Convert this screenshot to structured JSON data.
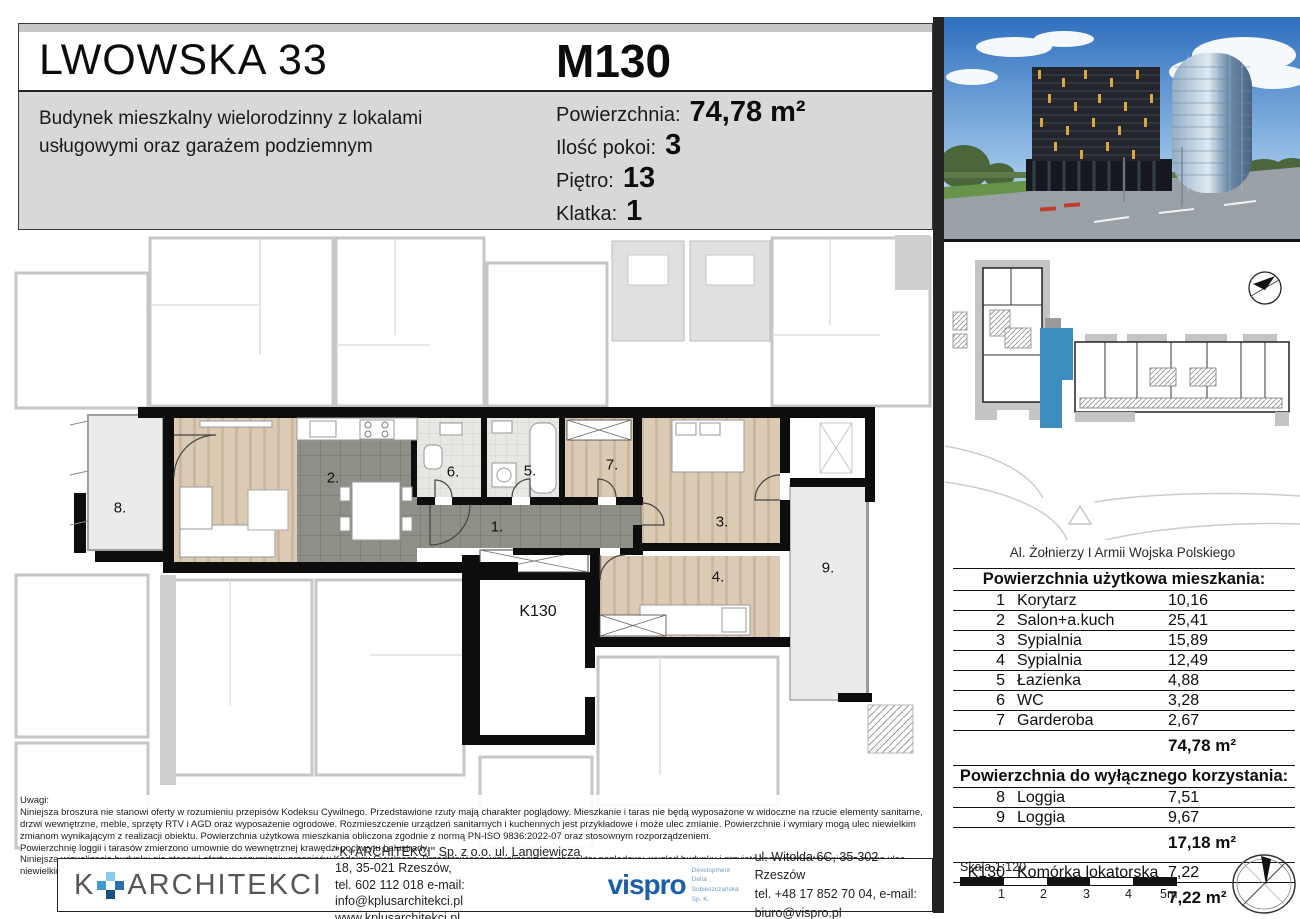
{
  "header": {
    "project_title": "LWOWSKA 33",
    "project_subtitle": "Budynek mieszkalny wielorodzinny z lokalami usługowymi oraz garażem podziemnym",
    "unit_id": "M130",
    "details": [
      {
        "label": "Powierzchnia:",
        "value": "74,78 m²"
      },
      {
        "label": "Ilość pokoi:",
        "value": "3"
      },
      {
        "label": "Piętro:",
        "value": "13"
      },
      {
        "label": "Klatka:",
        "value": "1"
      }
    ]
  },
  "site_plan": {
    "street_label": "Al. Żołnierzy I Armii Wojska Polskiego",
    "highlight_color": "#3d8ebf"
  },
  "floor_plan": {
    "room_labels": [
      "1.",
      "2.",
      "3.",
      "4.",
      "5.",
      "6.",
      "7.",
      "8.",
      "9."
    ],
    "storage_label": "K130"
  },
  "area_table": {
    "title": "Powierzchnia użytkowa mieszkania:",
    "rows": [
      {
        "no": "1",
        "name": "Korytarz",
        "area": "10,16"
      },
      {
        "no": "2",
        "name": "Salon+a.kuch",
        "area": "25,41"
      },
      {
        "no": "3",
        "name": "Sypialnia",
        "area": "15,89"
      },
      {
        "no": "4",
        "name": "Sypialnia",
        "area": "12,49"
      },
      {
        "no": "5",
        "name": "Łazienka",
        "area": "4,88"
      },
      {
        "no": "6",
        "name": "WC",
        "area": "3,28"
      },
      {
        "no": "7",
        "name": "Garderoba",
        "area": "2,67"
      }
    ],
    "total": "74,78 m²"
  },
  "exclusive_table": {
    "title": "Powierzchnia do wyłącznego korzystania:",
    "rows": [
      {
        "no": "8",
        "name": "Loggia",
        "area": "7,51"
      },
      {
        "no": "9",
        "name": "Loggia",
        "area": "9,67"
      }
    ],
    "total": "17,18 m²",
    "storage_row": {
      "no": "K130",
      "name": "Komórka lokatorska",
      "area": "7,22"
    },
    "storage_total": "7,22 m²"
  },
  "notes": {
    "title": "Uwagi:",
    "paragraphs": [
      "Niniejsza broszura nie stanowi oferty w rozumieniu przepisów Kodeksu Cywilnego. Przedstawione rzuty mają charakter poglądowy. Mieszkanie i taras nie będą wyposażone w widoczne na rzucie elementy sanitarne, drzwi wewnętrzne, meble, sprzęty RTV i AGD oraz wyposażenie ogrodowe. Rozmieszczenie urządzeń sanitarnych i kuchennych jest przykładowe i może ulec zmianie. Powierzchnie i wymiary mogą ulec niewielkim zmianom wynikającym z realizacji obiektu. Powierzchnia użytkowa mieszkania obliczona zgodnie z normą PN-ISO 9836:2022-07 oraz stosownym rozporządzeniem.",
      "Powierzchnię loggii i tarasów zmierzono umownie do wewnętrznej krawędzi pochwytu balustrady.",
      "Niniejsza wizualizacja budynku nie stanowi oferty w rozumieniu przepisów Kodeksu Cywilnego. Przedstawiona wizualizacja ma charakter poglądowy, wygląd budynku i przyjęte rozwiązania techniczne mogą ulec niewielkim zmianom wynikającym z realizacji obiektu."
    ]
  },
  "footer": {
    "architect": {
      "logo_k": "K",
      "logo_text": "ARCHITEKCI",
      "line1": "\"K+ARCHITEKCI\" Sp. z o.o. ul. Langiewicza 18, 35-021 Rzeszów,",
      "line2": "tel. 602 112 018 e-mail: info@kplusarchitekci.pl",
      "line3": "www.kplusarchitekci.pl"
    },
    "developer": {
      "logo": "vispro",
      "sub1": "Development",
      "sub2": "Delta Sobieszczańska Sp. K.",
      "line1": "ul. Witolda 6C, 35-302 Rzeszów",
      "line2": "tel. +48 17 852 70 04, e-mail: biuro@vispro.pl"
    }
  },
  "scale_bar": {
    "label": "Skala 1:120",
    "ticks": [
      "1",
      "2",
      "3",
      "4",
      "5m"
    ]
  },
  "colors": {
    "header_gray": "#d8d8d8",
    "unit_wall_black": "#0d0d0d",
    "wood_floor": "#dbcbb5",
    "tile_gray": "#8f8f88",
    "loggia_gray": "#ebebeb",
    "site_highlight_blue": "#3d8ebf",
    "vispro_blue": "#1b5ea9"
  }
}
